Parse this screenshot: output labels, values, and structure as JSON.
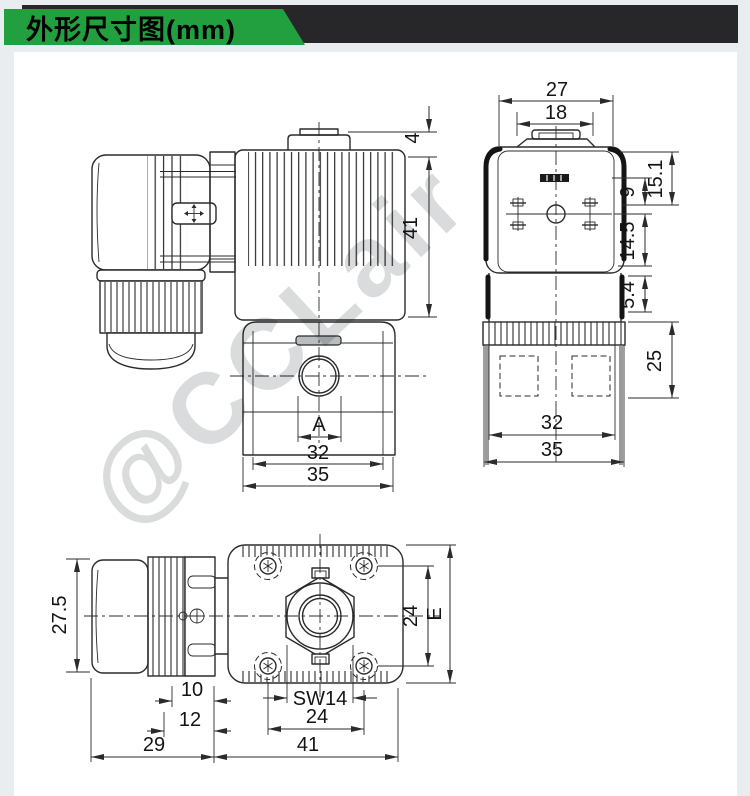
{
  "header": {
    "title": "外形尺寸图(mm)"
  },
  "colors": {
    "banner_green": "#229f3e",
    "banner_dark": "#27272a",
    "page_bg": "#e9edef",
    "panel_bg": "#ffffff",
    "line": "#2b2b2b",
    "watermark": "#d9dbdc"
  },
  "watermark": {
    "text": "@CCLair"
  },
  "views": {
    "side": {
      "d4": "4",
      "d41": "41",
      "dA": "A",
      "d32": "32",
      "d35": "35"
    },
    "front": {
      "d27": "27",
      "d18": "18",
      "d151": "15.1",
      "d9": "9",
      "d145": "14.5",
      "d54": "5.4",
      "d25": "25",
      "d32": "32",
      "d35": "35"
    },
    "top": {
      "d275": "27.5",
      "d10": "10",
      "d12": "12",
      "d29": "29",
      "d41": "41",
      "sw14": "SW14",
      "d24b": "24",
      "d24r": "24",
      "dE": "E"
    }
  }
}
